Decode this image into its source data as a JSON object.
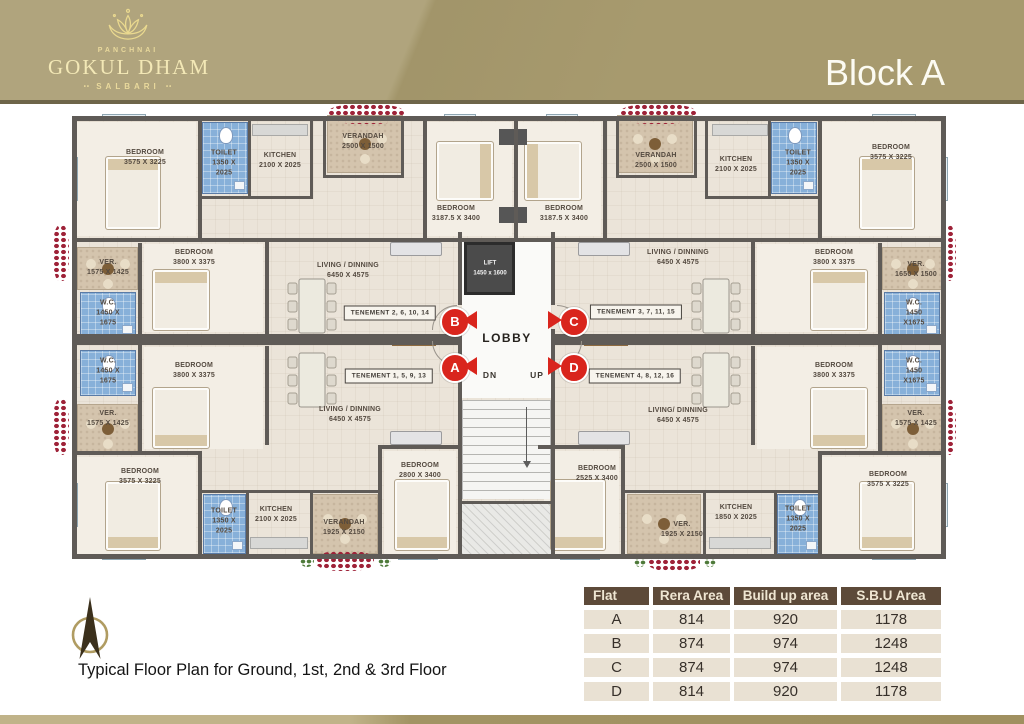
{
  "header": {
    "brand_top": "PANCHNAI",
    "brand_name": "GOKUL DHAM",
    "brand_sub": "SALBARI",
    "brand_sub_decor": "••",
    "block_title": "Block A"
  },
  "plan": {
    "lift": {
      "name": "LIFT",
      "dims": "1450 x 1600"
    },
    "lobby_label": "LOBBY",
    "dn_label": "DN",
    "up_label": "UP",
    "markers": [
      {
        "letter": "B",
        "x": 393,
        "y": 207,
        "dir": "left"
      },
      {
        "letter": "C",
        "x": 512,
        "y": 207,
        "dir": "right"
      },
      {
        "letter": "A",
        "x": 393,
        "y": 253,
        "dir": "left"
      },
      {
        "letter": "D",
        "x": 512,
        "y": 253,
        "dir": "right"
      }
    ],
    "tenements": [
      {
        "label": "TENEMENT 2, 6, 10, 14",
        "x": 330,
        "y": 200
      },
      {
        "label": "TENEMENT 1, 5, 9, 13",
        "x": 329,
        "y": 263
      },
      {
        "label": "TENEMENT 3, 7, 11, 15",
        "x": 576,
        "y": 199
      },
      {
        "label": "TENEMENT 4, 8, 12, 16",
        "x": 575,
        "y": 263
      }
    ],
    "rooms": [
      {
        "name": "BEDROOM",
        "dims": "3575 X 3225",
        "x": 85,
        "y": 45
      },
      {
        "name": "TOILET",
        "dims": "1350 X 2025",
        "x": 164,
        "y": 50,
        "w": 40
      },
      {
        "name": "KITCHEN",
        "dims": "2100 X 2025",
        "x": 220,
        "y": 48,
        "w": 52
      },
      {
        "name": "VERANDAH",
        "dims": "2500 X 1500",
        "x": 303,
        "y": 29
      },
      {
        "name": "LIVING / DINNING",
        "dims": "6450 X 4575",
        "x": 288,
        "y": 158
      },
      {
        "name": "BEDROOM",
        "dims": "3800 X 3375",
        "x": 134,
        "y": 145
      },
      {
        "name": "VER.",
        "dims": "1575 X 1425",
        "x": 48,
        "y": 155,
        "w": 46
      },
      {
        "name": "W.C.",
        "dims": "1450 X 1675",
        "x": 48,
        "y": 200,
        "w": 36
      },
      {
        "name": "W.C.",
        "dims": "1450 X 1675",
        "x": 48,
        "y": 258,
        "w": 36
      },
      {
        "name": "VER.",
        "dims": "1575 X 1425",
        "x": 48,
        "y": 306,
        "w": 46
      },
      {
        "name": "BEDROOM",
        "dims": "3800 X 3375",
        "x": 134,
        "y": 258
      },
      {
        "name": "LIVING / DINNING",
        "dims": "6450 X 4575",
        "x": 290,
        "y": 302
      },
      {
        "name": "BEDROOM",
        "dims": "3575 X 3225",
        "x": 80,
        "y": 364
      },
      {
        "name": "TOILET",
        "dims": "1350 X 2025",
        "x": 164,
        "y": 408,
        "w": 40
      },
      {
        "name": "KITCHEN",
        "dims": "2100 X 2025",
        "x": 216,
        "y": 402,
        "w": 52
      },
      {
        "name": "VERANDAH",
        "dims": "1925 X 2150",
        "x": 284,
        "y": 415,
        "w": 56
      },
      {
        "name": "BEDROOM",
        "dims": "2800 X 3400",
        "x": 360,
        "y": 358
      },
      {
        "name": "BEDROOM",
        "dims": "3187.5 X 3400",
        "x": 396,
        "y": 101
      },
      {
        "name": "BEDROOM",
        "dims": "3187.5 X 3400",
        "x": 504,
        "y": 101
      },
      {
        "name": "VERANDAH",
        "dims": "2500 X 1500",
        "x": 596,
        "y": 48
      },
      {
        "name": "KITCHEN",
        "dims": "2100 X 2025",
        "x": 676,
        "y": 52,
        "w": 52
      },
      {
        "name": "TOILET",
        "dims": "1350 X 2025",
        "x": 738,
        "y": 50,
        "w": 40
      },
      {
        "name": "BEDROOM",
        "dims": "3575 X 3225",
        "x": 831,
        "y": 40
      },
      {
        "name": "LIVING / DINNING",
        "dims": "6450 X 4575",
        "x": 618,
        "y": 145
      },
      {
        "name": "BEDROOM",
        "dims": "3800 X 3375",
        "x": 774,
        "y": 145
      },
      {
        "name": "VER.",
        "dims": "1650 X 1500",
        "x": 856,
        "y": 157,
        "w": 46
      },
      {
        "name": "W.C.",
        "dims": "1450 X1675",
        "x": 854,
        "y": 200,
        "w": 36
      },
      {
        "name": "W.C.",
        "dims": "1450 X1675",
        "x": 854,
        "y": 258,
        "w": 36
      },
      {
        "name": "VER.",
        "dims": "1575 X 1425",
        "x": 856,
        "y": 306,
        "w": 46
      },
      {
        "name": "BEDROOM",
        "dims": "3800 X 3375",
        "x": 774,
        "y": 258
      },
      {
        "name": "LIVING/ DINNING",
        "dims": "6450 X 4575",
        "x": 618,
        "y": 303
      },
      {
        "name": "BEDROOM",
        "dims": "2525 X 3400",
        "x": 537,
        "y": 361
      },
      {
        "name": "VER.",
        "dims": "1925 X 2150",
        "x": 622,
        "y": 417,
        "w": 52
      },
      {
        "name": "KITCHEN",
        "dims": "1850 X 2025",
        "x": 676,
        "y": 400,
        "w": 52
      },
      {
        "name": "TOILET",
        "dims": "1350 X 2025",
        "x": 738,
        "y": 406,
        "w": 40
      },
      {
        "name": "BEDROOM",
        "dims": "3575 X 3225",
        "x": 828,
        "y": 367
      }
    ]
  },
  "footer": {
    "caption": "Typical Floor Plan for Ground, 1st, 2nd & 3rd Floor"
  },
  "area_table": {
    "headers": [
      "Flat",
      "Rera Area",
      "Build up area",
      "S.B.U Area"
    ],
    "rows": [
      [
        "A",
        "814",
        "920",
        "1178"
      ],
      [
        "B",
        "874",
        "974",
        "1248"
      ],
      [
        "C",
        "874",
        "974",
        "1248"
      ],
      [
        "D",
        "814",
        "920",
        "1178"
      ]
    ]
  },
  "colors": {
    "header_bg": "#a79a6e",
    "accent_red": "#d9251d",
    "table_header_bg": "#5d4a39",
    "wall_gray": "#5f5b57"
  }
}
